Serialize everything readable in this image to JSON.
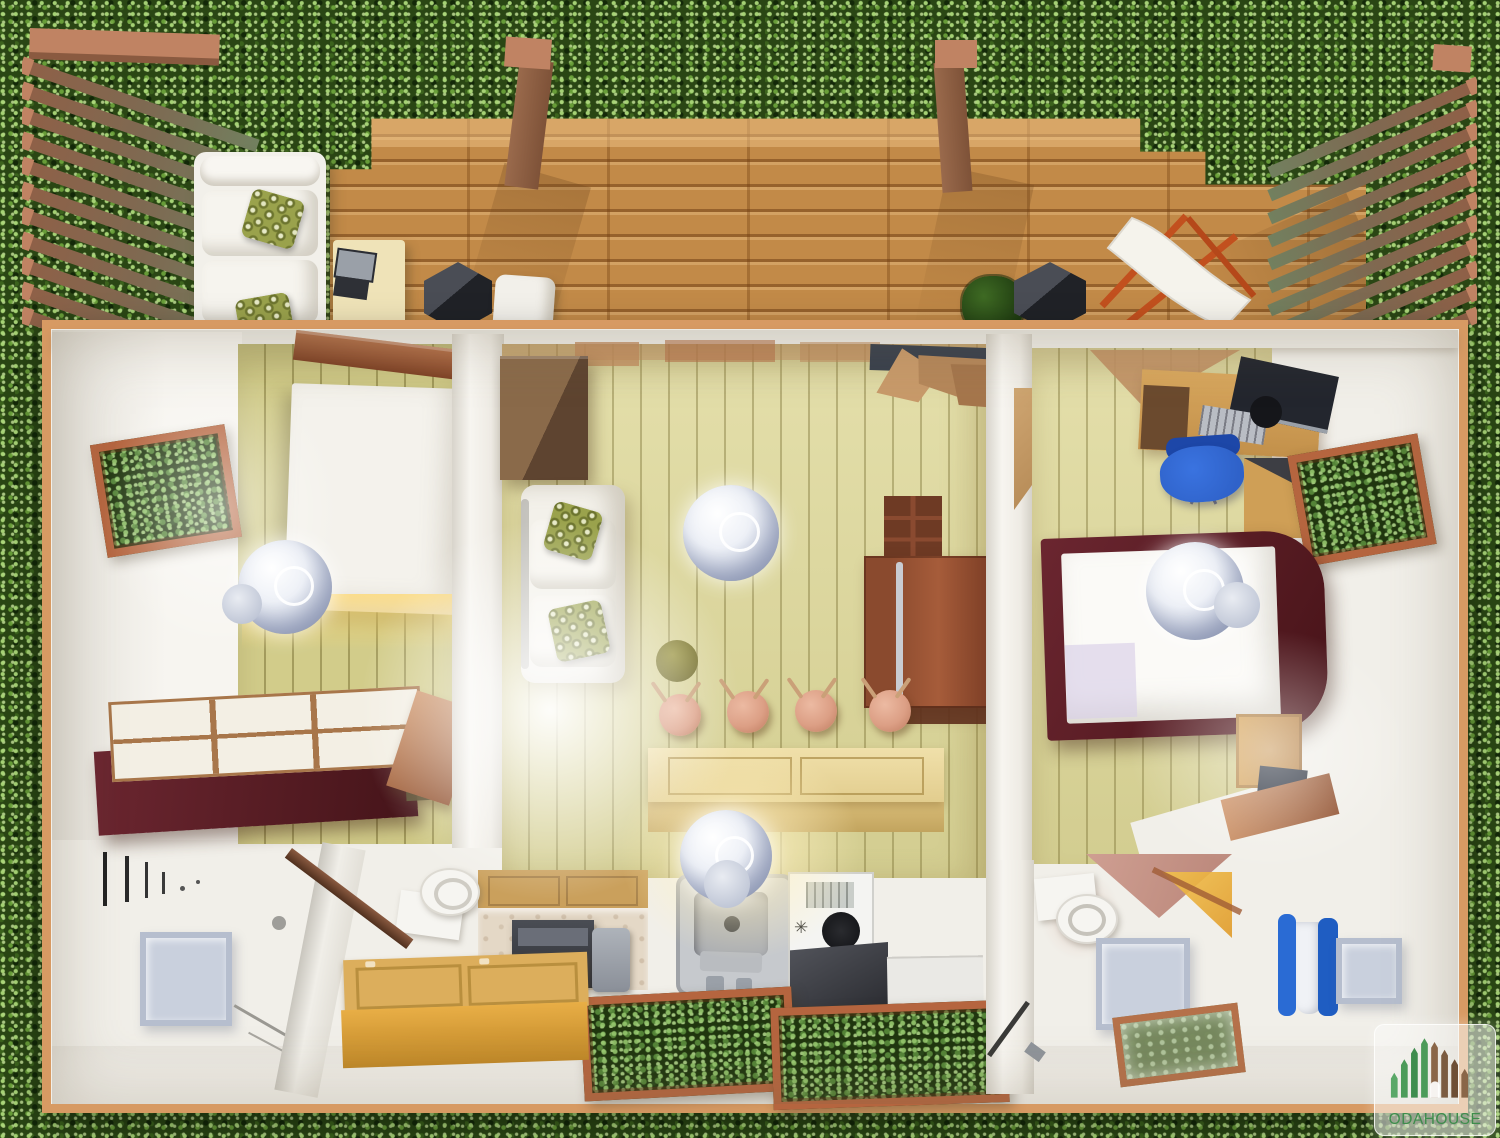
{
  "watermark": {
    "brand": "ODAHOUSE"
  },
  "icons": {
    "burner_star": "✳"
  },
  "palette": {
    "grass_base": "#2a4614",
    "deck_wood": "#c28a48",
    "deck_seam": "#8a5524",
    "house_frame": "#d79a63",
    "wall_white": "#f1efe9",
    "floor_plank": "#ded898",
    "panel_wood": "#d2cc8a",
    "burgundy": "#551d25",
    "copper": "#b5653f",
    "honey_wood": "#dcae5c",
    "cabinet_brown": "#8a4a2e",
    "stool_copper": "#dc9f85",
    "chair_blue": "#2f62c9",
    "towel_blue": "#2a6bd4",
    "lamp_grey": "#b9c1d6",
    "slat_brown": "#8a5f46",
    "slat_cap": "#c08363",
    "logo_green": "#4c9b59",
    "logo_brown": "#7b5b40",
    "logo_text": "#3e8d4c"
  }
}
